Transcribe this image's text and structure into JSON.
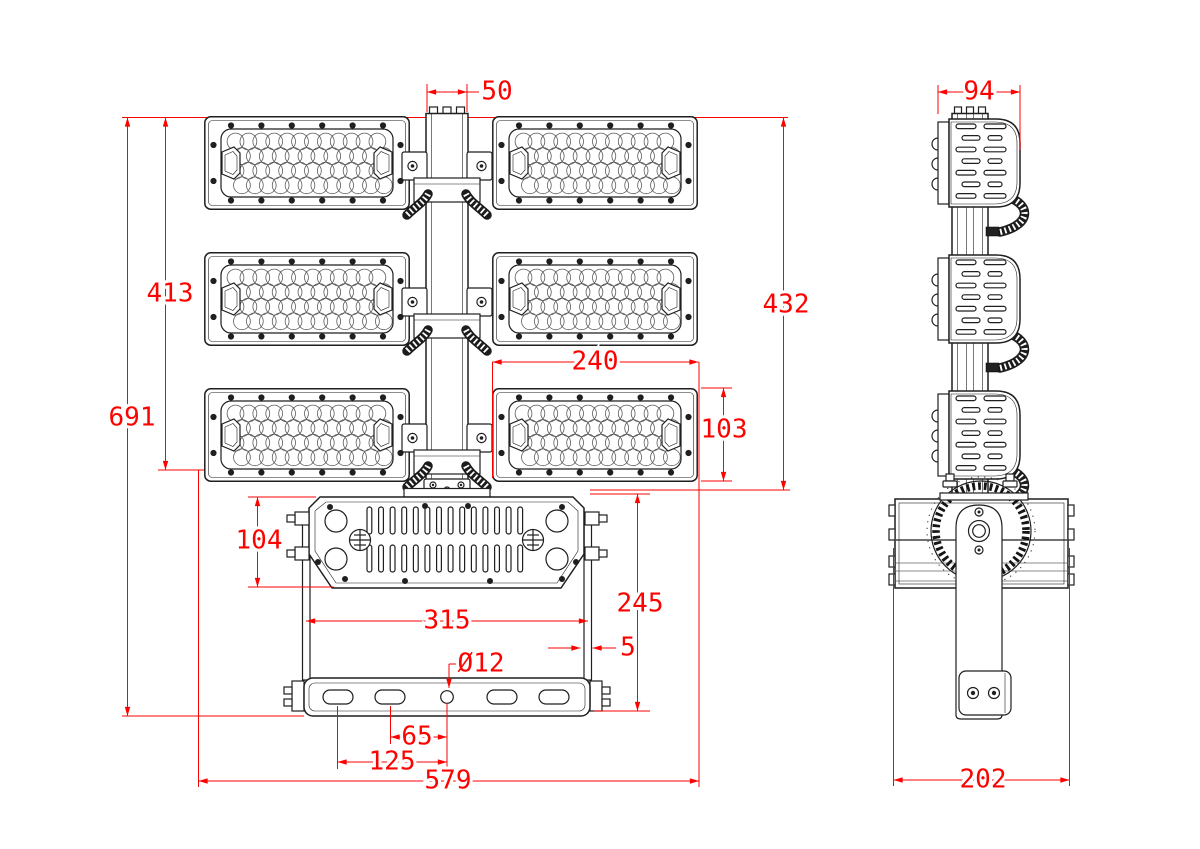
{
  "drawing_type": "technical-dimension-drawing",
  "subject": "LED flood light fixture, front and side orthographic views",
  "colors": {
    "line": "#1f1f1f",
    "dimension": "#fb0300",
    "background": "#ffffff"
  },
  "front_view": {
    "dimensions": {
      "pole_top_width": "50",
      "modules_stack_height": "413",
      "overall_height": "691",
      "modules_to_driver_box": "432",
      "module_width": "240",
      "module_height": "103",
      "driver_box_height": "104",
      "yoke_inner_width": "315",
      "pivot_to_base_height": "245",
      "yoke_arm_thickness": "5",
      "mounting_hole_diameter": "Ø12",
      "slot_offset_inner": "65",
      "slot_offset_outer": "125",
      "overall_width": "579"
    }
  },
  "side_view": {
    "dimensions": {
      "module_depth": "94",
      "overall_depth": "202"
    }
  }
}
